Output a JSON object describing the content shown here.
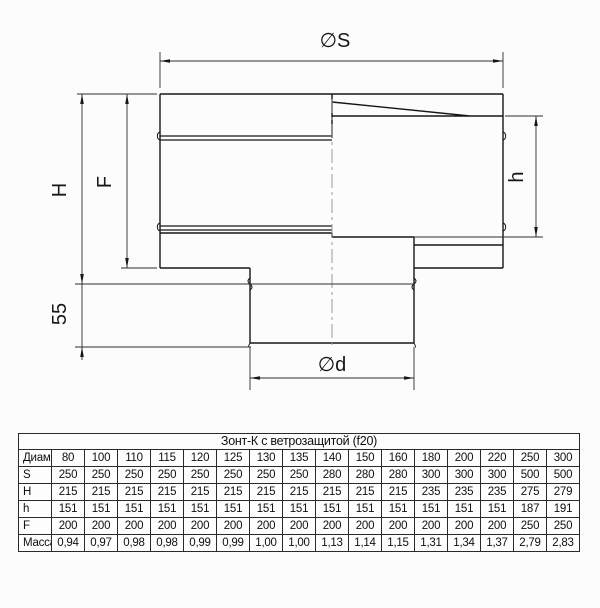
{
  "drawing": {
    "labels": {
      "phi_s": "∅S",
      "height_H": "H",
      "height_F": "F",
      "height_h": "h",
      "offset_55": "55",
      "phi_d": "∅d"
    }
  },
  "table": {
    "title": "Зонт-К с ветрозащитой (f20)",
    "header": [
      "Диаметр",
      "80",
      "100",
      "110",
      "115",
      "120",
      "125",
      "130",
      "135",
      "140",
      "150",
      "160",
      "180",
      "200",
      "220",
      "250",
      "300"
    ],
    "rows": [
      {
        "label": "S",
        "values": [
          "250",
          "250",
          "250",
          "250",
          "250",
          "250",
          "250",
          "250",
          "280",
          "280",
          "280",
          "300",
          "300",
          "300",
          "500",
          "500"
        ]
      },
      {
        "label": "H",
        "values": [
          "215",
          "215",
          "215",
          "215",
          "215",
          "215",
          "215",
          "215",
          "215",
          "215",
          "215",
          "235",
          "235",
          "235",
          "275",
          "279"
        ]
      },
      {
        "label": "h",
        "values": [
          "151",
          "151",
          "151",
          "151",
          "151",
          "151",
          "151",
          "151",
          "151",
          "151",
          "151",
          "151",
          "151",
          "151",
          "187",
          "191"
        ]
      },
      {
        "label": "F",
        "values": [
          "200",
          "200",
          "200",
          "200",
          "200",
          "200",
          "200",
          "200",
          "200",
          "200",
          "200",
          "200",
          "200",
          "200",
          "250",
          "250"
        ]
      },
      {
        "label": "Масса 0,5",
        "values": [
          "0,94",
          "0,97",
          "0,98",
          "0,98",
          "0,99",
          "0,99",
          "1,00",
          "1,00",
          "1,13",
          "1,14",
          "1,15",
          "1,31",
          "1,34",
          "1,37",
          "2,79",
          "2,83"
        ]
      }
    ]
  },
  "colors": {
    "outline": "#161616",
    "dimension": "#2e2e2e",
    "centerline": "#8f8f8f",
    "background": "#fcfcfc"
  }
}
